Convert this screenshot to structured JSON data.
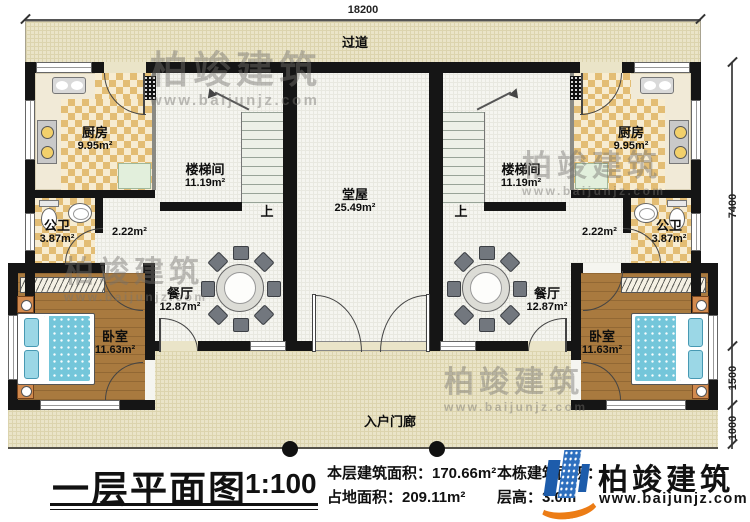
{
  "dims": {
    "top": "18200",
    "right_upper": "7400",
    "right_mid": "1500",
    "right_lower": "1000"
  },
  "corridor": {
    "label": "过道"
  },
  "porch": {
    "label": "入户门廊"
  },
  "stairs": {
    "up_left": "上",
    "up_right": "上"
  },
  "rooms": {
    "kitchen_left": {
      "name": "厨房",
      "area": "9.95m²"
    },
    "kitchen_right": {
      "name": "厨房",
      "area": "9.95m²"
    },
    "stair_left": {
      "name": "楼梯间",
      "area": "11.19m²"
    },
    "stair_right": {
      "name": "楼梯间",
      "area": "11.19m²"
    },
    "hall": {
      "name": "堂屋",
      "area": "25.49m²"
    },
    "bath_left": {
      "name": "公卫",
      "area": "3.87m²"
    },
    "bath_right": {
      "name": "公卫",
      "area": "3.87m²"
    },
    "pass_left": {
      "area": "2.22m²"
    },
    "pass_right": {
      "area": "2.22m²"
    },
    "dining_left": {
      "name": "餐厅",
      "area": "12.87m²"
    },
    "dining_right": {
      "name": "餐厅",
      "area": "12.87m²"
    },
    "bedroom_left": {
      "name": "卧室",
      "area": "11.63m²"
    },
    "bedroom_right": {
      "name": "卧室",
      "area": "11.63m²"
    }
  },
  "titleblock": {
    "title": "一层平面图",
    "scale": "1:100",
    "line1": "本层建筑面积：170.66m²",
    "line2": "占地面积：209.11m²",
    "line3": "本栋建筑面积：",
    "line4": "层高：3.0m"
  },
  "brand": {
    "name": "柏竣建筑",
    "url": "www.baijunjz.com"
  },
  "watermark": {
    "name": "柏竣建筑",
    "url": "www.baijunjz.com"
  }
}
